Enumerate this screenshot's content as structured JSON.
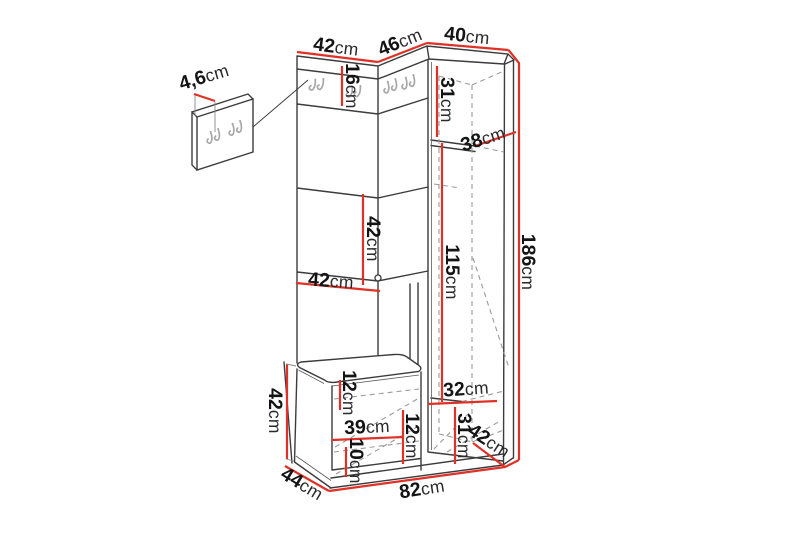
{
  "figure": {
    "type": "furniture-dimension-diagram",
    "description": "Line drawing of a corner hallway unit (coat-hook panels, mirror section, shoe bench and tall corner wardrobe) with a separate wall hook panel, annotated with centimetre dimensions in red",
    "unit": "cm"
  },
  "colors": {
    "background": "#ffffff",
    "outline": "#3c3c3c",
    "dimension_line": "#e03127",
    "label_text": "#141414",
    "hook": "#a8a8a8"
  },
  "labels": {
    "panel_thickness": {
      "value": "4,6",
      "unit": "cm"
    },
    "top_left_width": {
      "value": "42",
      "unit": "cm"
    },
    "top_corner_width": {
      "value": "46",
      "unit": "cm"
    },
    "top_right_width": {
      "value": "40",
      "unit": "cm"
    },
    "hook_strip_height": {
      "value": "16",
      "unit": "cm"
    },
    "cabinet_upper_height": {
      "value": "31",
      "unit": "cm"
    },
    "cabinet_shelf_depth": {
      "value": "38",
      "unit": "cm"
    },
    "mirror_panel_height": {
      "value": "42",
      "unit": "cm"
    },
    "left_section_width": {
      "value": "42",
      "unit": "cm"
    },
    "cabinet_lower_height": {
      "value": "115",
      "unit": "cm"
    },
    "total_height": {
      "value": "186",
      "unit": "cm"
    },
    "bench_height": {
      "value": "42",
      "unit": "cm"
    },
    "seat_thickness": {
      "value": "12",
      "unit": "cm"
    },
    "bench_shelf_width": {
      "value": "39",
      "unit": "cm"
    },
    "bench_gap_height": {
      "value": "12",
      "unit": "cm"
    },
    "bench_shelf_gap_height": {
      "value": "10",
      "unit": "cm"
    },
    "cabinet_bottom_shelf_width": {
      "value": "32",
      "unit": "cm"
    },
    "cabinet_bottom_height": {
      "value": "31",
      "unit": "cm"
    },
    "cabinet_depth": {
      "value": "42",
      "unit": "cm"
    },
    "unit_depth": {
      "value": "44",
      "unit": "cm"
    },
    "base_width": {
      "value": "82",
      "unit": "cm"
    }
  }
}
